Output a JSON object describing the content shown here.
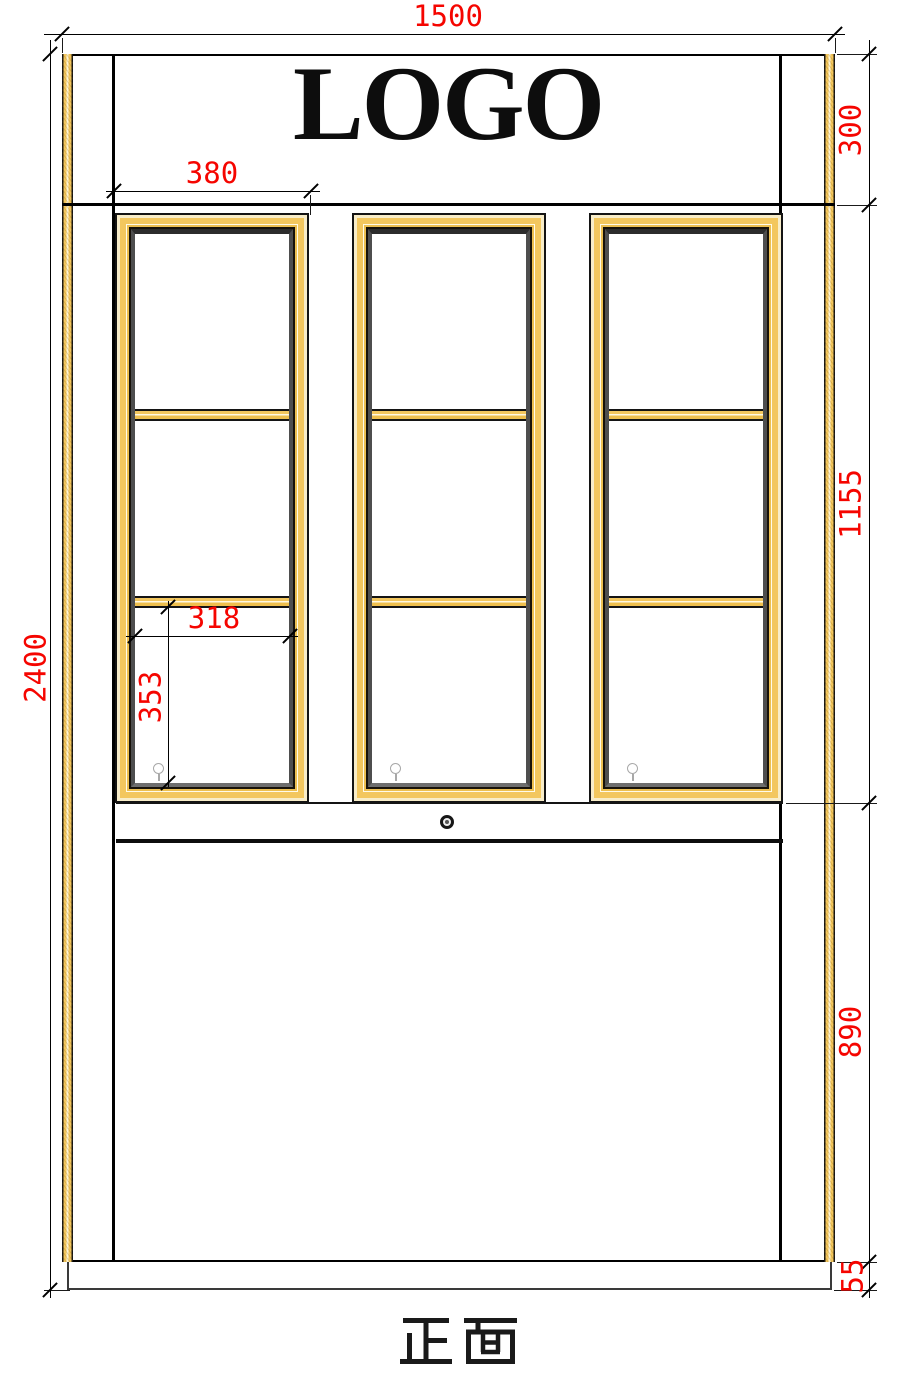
{
  "header": {
    "logo_text": "LOGO"
  },
  "footer": {
    "view_label": "正面"
  },
  "dimensions": {
    "overall_width": "1500",
    "overall_height": "2400",
    "top_panel_height": "300",
    "door_section_height": "1155",
    "lower_section_height": "890",
    "base_height": "55",
    "door_width": "380",
    "pane_width": "318",
    "pane_height": "353"
  },
  "structure": {
    "door_count": "3",
    "panes_per_door": "3"
  },
  "colors": {
    "dimension_red": "#f50500",
    "wood_gold": "#f3c75e",
    "wood_cream": "#f8edc9",
    "line_black": "#141414",
    "bevel_gray": "#2c2c2c",
    "hardware_gray": "#a8a8a8"
  },
  "icons": {
    "door_knob": "lollipop-knob",
    "center_lock": "ring-knob"
  }
}
